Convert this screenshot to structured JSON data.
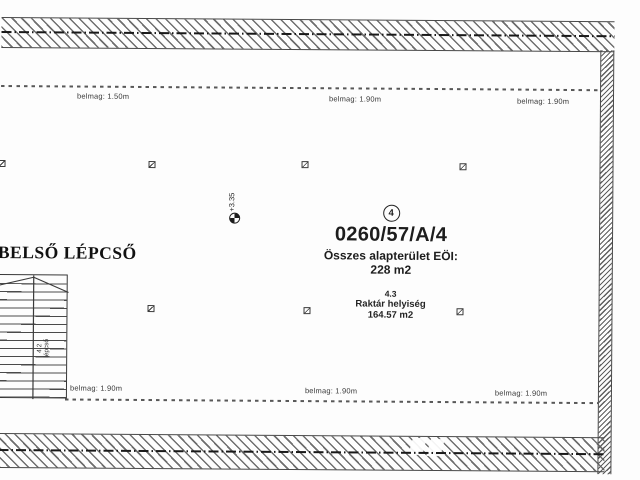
{
  "drawing": {
    "kind": "floor-plan",
    "unit": {
      "number": "4",
      "parcel_id": "0260/57/A/4",
      "area_label": "Összes alapterület EÖI:",
      "area_value": "228 m2",
      "room_code": "4.3",
      "room_name": "Raktár helyiség",
      "room_area": "164.57 m2"
    },
    "staircase": {
      "title": "BELSŐ LÉPCSŐ",
      "code": "4.2",
      "name": "lépcső"
    },
    "level_marker": {
      "value": "+3.35"
    },
    "heights": {
      "top": [
        "belmag: 1.50m",
        "belmag: 1.90m",
        "belmag: 1.90m"
      ],
      "bottom": [
        "belmag: 1.90m",
        "belmag: 1.90m",
        "belmag: 1.90m"
      ]
    },
    "icons": {
      "square_marker": "hatched-square",
      "level_marker": "quartered-survey-circle"
    },
    "colors": {
      "wall_hatch": "#5f5f5f",
      "wall_outline": "#484848",
      "wall_centerline": "#191919",
      "dashed_boundary": "#585858",
      "text": "#1d1d1d",
      "background": "#fdfdfd"
    }
  }
}
